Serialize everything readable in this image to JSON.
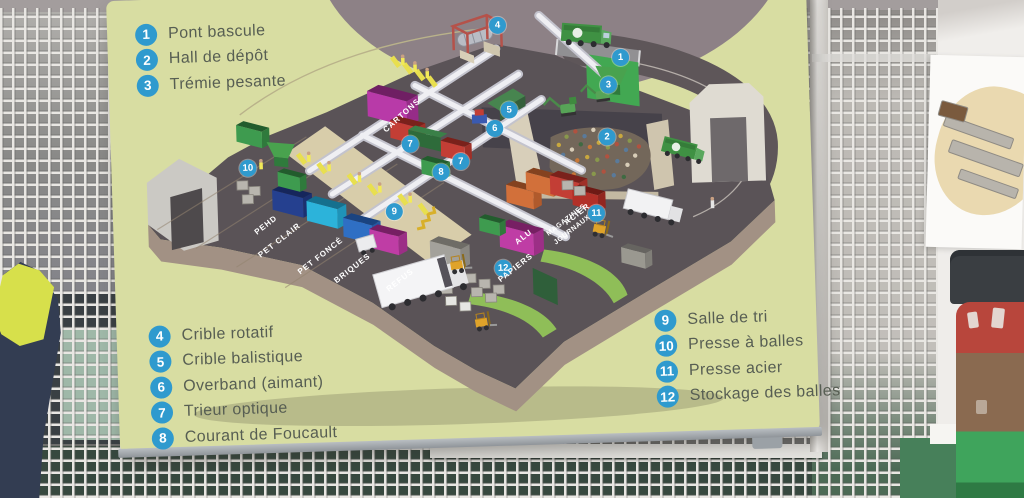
{
  "sign": {
    "legend": [
      {
        "num": "1",
        "label": "Pont bascule"
      },
      {
        "num": "2",
        "label": "Hall de dépôt"
      },
      {
        "num": "3",
        "label": "Trémie pesante"
      },
      {
        "num": "4",
        "label": "Crible rotatif"
      },
      {
        "num": "5",
        "label": "Crible balistique"
      },
      {
        "num": "6",
        "label": "Overband (aimant)"
      },
      {
        "num": "7",
        "label": "Trieur optique"
      },
      {
        "num": "8",
        "label": "Courant de Foucault"
      },
      {
        "num": "9",
        "label": "Salle de tri"
      },
      {
        "num": "10",
        "label": "Presse à balles"
      },
      {
        "num": "11",
        "label": "Presse acier"
      },
      {
        "num": "12",
        "label": "Stockage des balles"
      }
    ],
    "floor_labels": {
      "pehd": "PEHD",
      "pet_clair": "PET CLAIR",
      "pet_fonce": "PET FONCÉ",
      "briques": "BRIQUES",
      "refus": "REFUS",
      "cartons": "CARTONS",
      "papiers": "PAPIERS",
      "acier": "ACIER",
      "magazines": "MAGAZINES",
      "journaux": "JOURNAUX",
      "alu": "ALU"
    },
    "colors": {
      "sign_bg": "#d8dda2",
      "marker_blue": "#2f9ace",
      "legend_text": "#575e53",
      "floor_dark": "#5a5357",
      "floor_base": "#a29184",
      "backdrop_mauve": "#8d8186",
      "conveyor": "#efeff3",
      "platform_beige": "#d8cdaa",
      "worker_yellow": "#e8df4f",
      "truck_green": "#3f9143"
    }
  }
}
